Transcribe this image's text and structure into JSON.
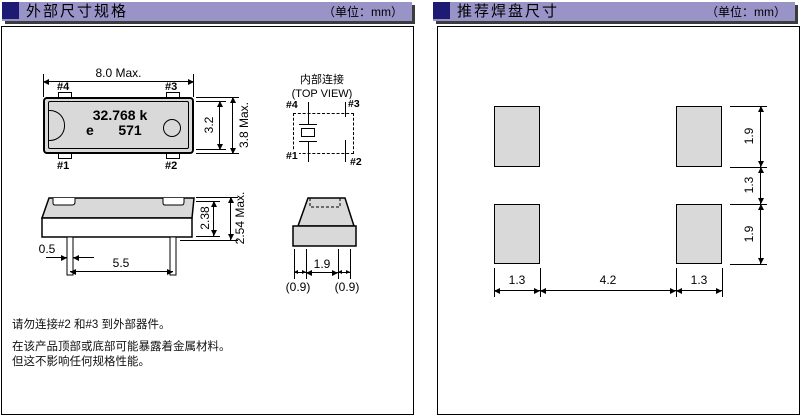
{
  "panels": {
    "external_dimensions": {
      "header": {
        "title": "外部尺寸规格",
        "unit": "（单位：mm）"
      },
      "top_view": {
        "dim_width": "8.0 Max.",
        "dim_inner_height": "3.2",
        "dim_outer_height": "3.8 Max.",
        "marking_frequency": "32.768 k",
        "marking_e": "e",
        "marking_code": "571",
        "pin_top_left": "#4",
        "pin_top_right": "#3",
        "pin_bottom_left": "#1",
        "pin_bottom_right": "#2"
      },
      "internal_connection": {
        "title": "内部连接",
        "subtitle": "(TOP VIEW)",
        "pin_top_left": "#4",
        "pin_top_right": "#3",
        "pin_bottom_left": "#1",
        "pin_bottom_right": "#2"
      },
      "side_view": {
        "dim_body_height": "2.38",
        "dim_total_height": "2.54 Max.",
        "dim_lead_width": "0.5",
        "dim_lead_spacing": "5.5"
      },
      "end_view": {
        "dim_lead_gap": "1.9",
        "dim_lead_width_left": "(0.9)",
        "dim_lead_width_right": "(0.9)"
      },
      "notes": [
        "请勿连接#2 和#3 到外部器件。",
        "在该产品顶部或底部可能暴露着金属材料。",
        "但这不影响任何规格性能。"
      ]
    },
    "recommended_pads": {
      "header": {
        "title": "推荐焊盘尺寸",
        "unit": "（单位：mm）"
      },
      "pad_layout": {
        "dim_pad_width_left": "1.3",
        "dim_pad_gap_horizontal": "4.2",
        "dim_pad_width_right": "1.3",
        "dim_pad_height_top": "1.9",
        "dim_pad_gap_vertical": "1.3",
        "dim_pad_height_bottom": "1.9"
      }
    }
  },
  "colors": {
    "header_bar": "#9894c8",
    "header_square": "#1d1b73",
    "header_shadow": "#3c3c3c",
    "drawing_fill": "#d9d9d9",
    "line": "#000000"
  }
}
